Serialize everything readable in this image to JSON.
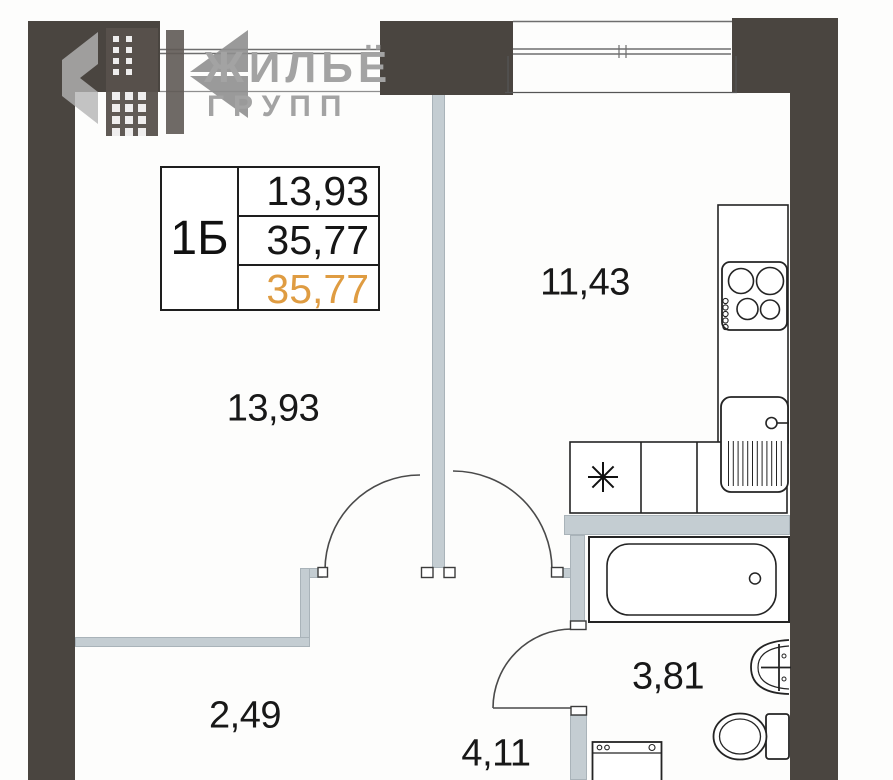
{
  "brand": {
    "name_line1": "ЖИЛЬЁ",
    "name_line2": "ГРУПП"
  },
  "unit_card": {
    "unit_type": "1Б",
    "area_rows": [
      "13,93",
      "35,77",
      "35,77"
    ],
    "highlighted_row_index": 2
  },
  "room_areas": {
    "living_room": "13,93",
    "kitchen": "11,43",
    "hallway": "2,49",
    "corridor": "4,11",
    "bathroom": "3,81"
  },
  "palette": {
    "wall_dark": "#4a4540",
    "wall_light": "#c4cdd2",
    "line": "#242424",
    "accent": "#df9c42"
  }
}
